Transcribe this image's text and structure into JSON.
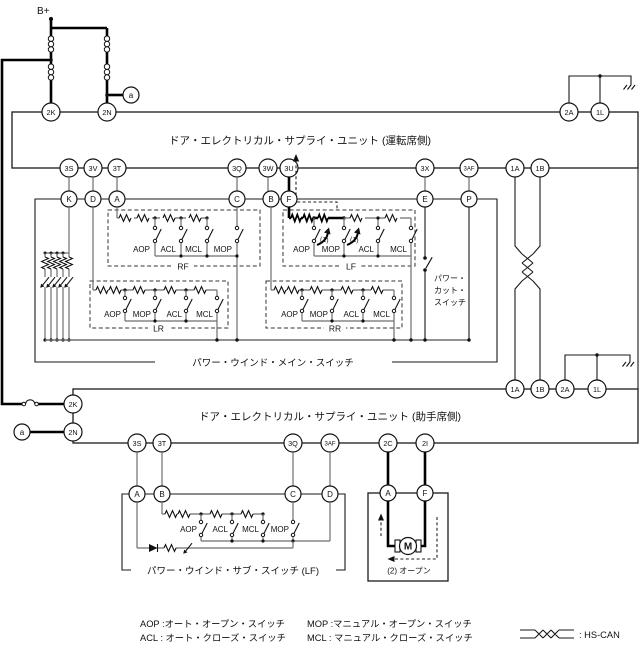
{
  "top": {
    "battery": "B+",
    "conn_a1": "a",
    "conn_a2": "a"
  },
  "unit1": {
    "title": "ドア・エレクトリカル・サプライ・ユニット (運転席側)",
    "pins": {
      "k2": "2K",
      "n2": "2N",
      "a2": "2A",
      "l1": "1L",
      "s3": "3S",
      "v3": "3V",
      "t3": "3T",
      "q3": "3Q",
      "w3": "3W",
      "u3": "3U",
      "x3": "3X",
      "af3": "3AF",
      "a1": "1A",
      "b1": "1B"
    }
  },
  "main_switch": {
    "label": "パワー・ウインド・メイン・スイッチ",
    "pins": {
      "k": "K",
      "d": "D",
      "a": "A",
      "c": "C",
      "b": "B",
      "f": "F",
      "e": "E",
      "p": "P"
    },
    "rf": {
      "name": "RF",
      "sw": [
        "AOP",
        "ACL",
        "MCL",
        "MOP"
      ]
    },
    "lf": {
      "name": "LF",
      "sw": [
        "AOP",
        "MOP",
        "ACL",
        "MCL"
      ],
      "step1a": "(1)",
      "step1b": "(1)"
    },
    "lr": {
      "name": "LR",
      "sw": [
        "AOP",
        "MOP",
        "ACL",
        "MCL"
      ]
    },
    "rr": {
      "name": "RR",
      "sw": [
        "AOP",
        "MOP",
        "ACL",
        "MCL"
      ]
    },
    "power_cut": {
      "line1": "パワー・",
      "line2": "カット・",
      "line3": "スイッチ"
    }
  },
  "unit2": {
    "title": "ドア・エレクトリカル・サプライ・ユニット (助手席側)",
    "pins": {
      "k2": "2K",
      "n2": "2N",
      "a1": "1A",
      "b1": "1B",
      "a2": "2A",
      "l1": "1L",
      "s3": "3S",
      "t3": "3T",
      "q3": "3Q",
      "af3": "3AF",
      "c2": "2C",
      "i2": "2I"
    }
  },
  "sub_switch": {
    "label": "パワー・ウインド・サブ・スイッチ (LF)",
    "pins": {
      "a": "A",
      "b": "B",
      "c": "C",
      "d": "D"
    },
    "sw": [
      "AOP",
      "ACL",
      "MCL",
      "MOP"
    ]
  },
  "motor": {
    "pin_a": "A",
    "pin_f": "F",
    "m": "M",
    "step2": "(2) オープン"
  },
  "legend": {
    "aop": "AOP :オート・オープン・スイッチ",
    "acl": "ACL : オート・クローズ・スイッチ",
    "mop": "MOP :マニュアル・オープン・スイッチ",
    "mcl": "MCL : マニュアル・クローズ・スイッチ",
    "hscan": ": HS-CAN"
  }
}
